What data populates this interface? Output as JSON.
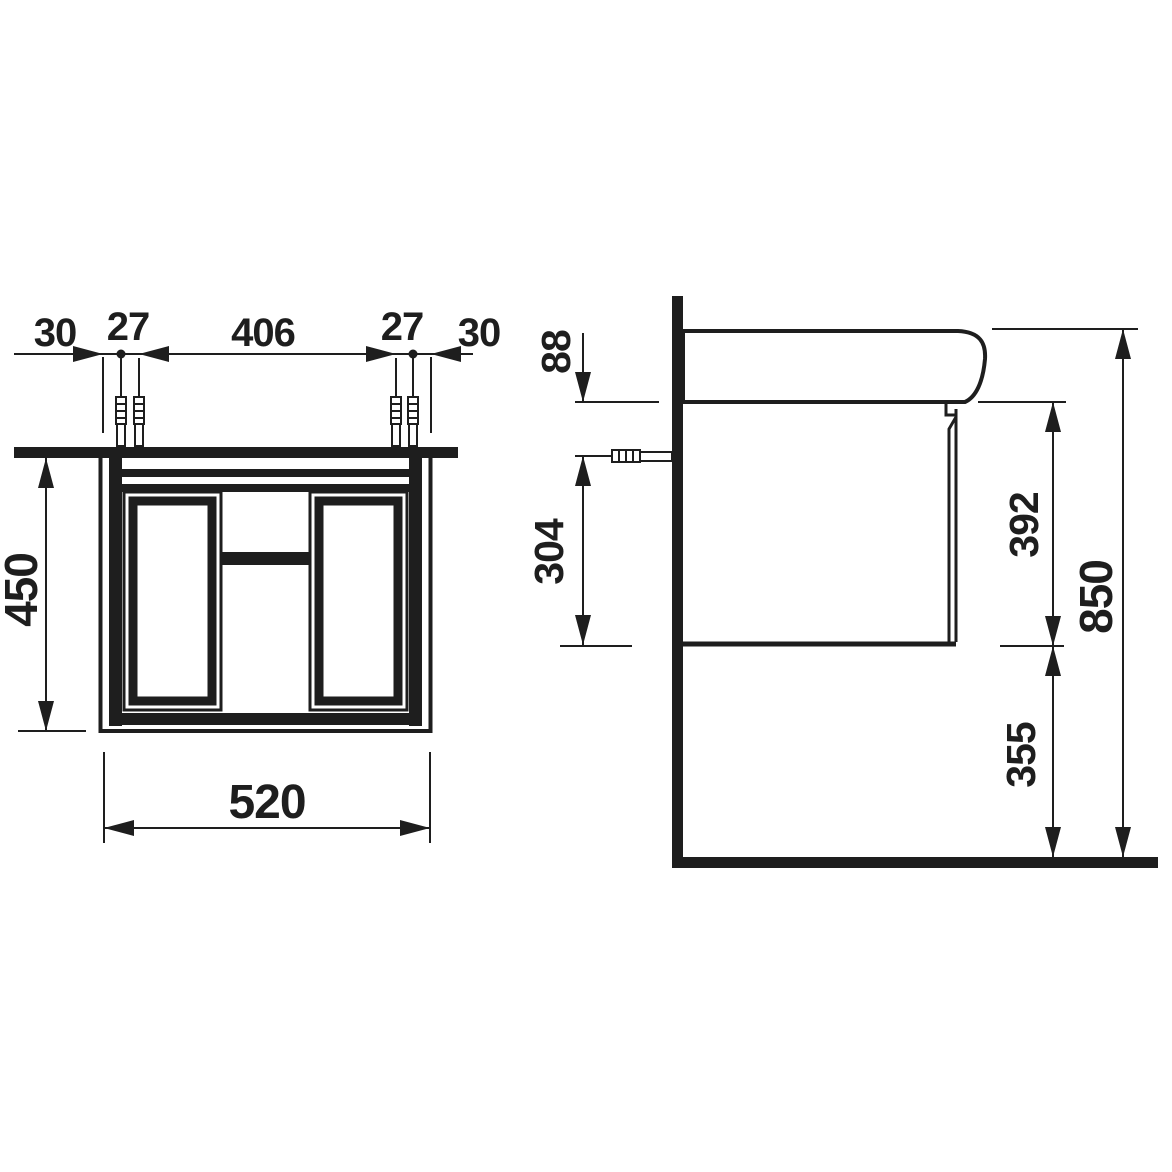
{
  "title": "Vanity unit technical drawing",
  "colors": {
    "ink": "#1e1e1e",
    "paper": "#ffffff"
  },
  "front_view": {
    "dims": {
      "edge_offset_left": "30",
      "anchor_gap_left": "27",
      "anchor_span": "406",
      "anchor_gap_right": "27",
      "edge_offset_right": "30",
      "height": "450",
      "width": "520"
    }
  },
  "side_view": {
    "dims": {
      "basin_height": "88",
      "anchor_to_bottom": "304",
      "cabinet_height": "392",
      "total_height": "850",
      "floor_clearance": "355"
    }
  }
}
